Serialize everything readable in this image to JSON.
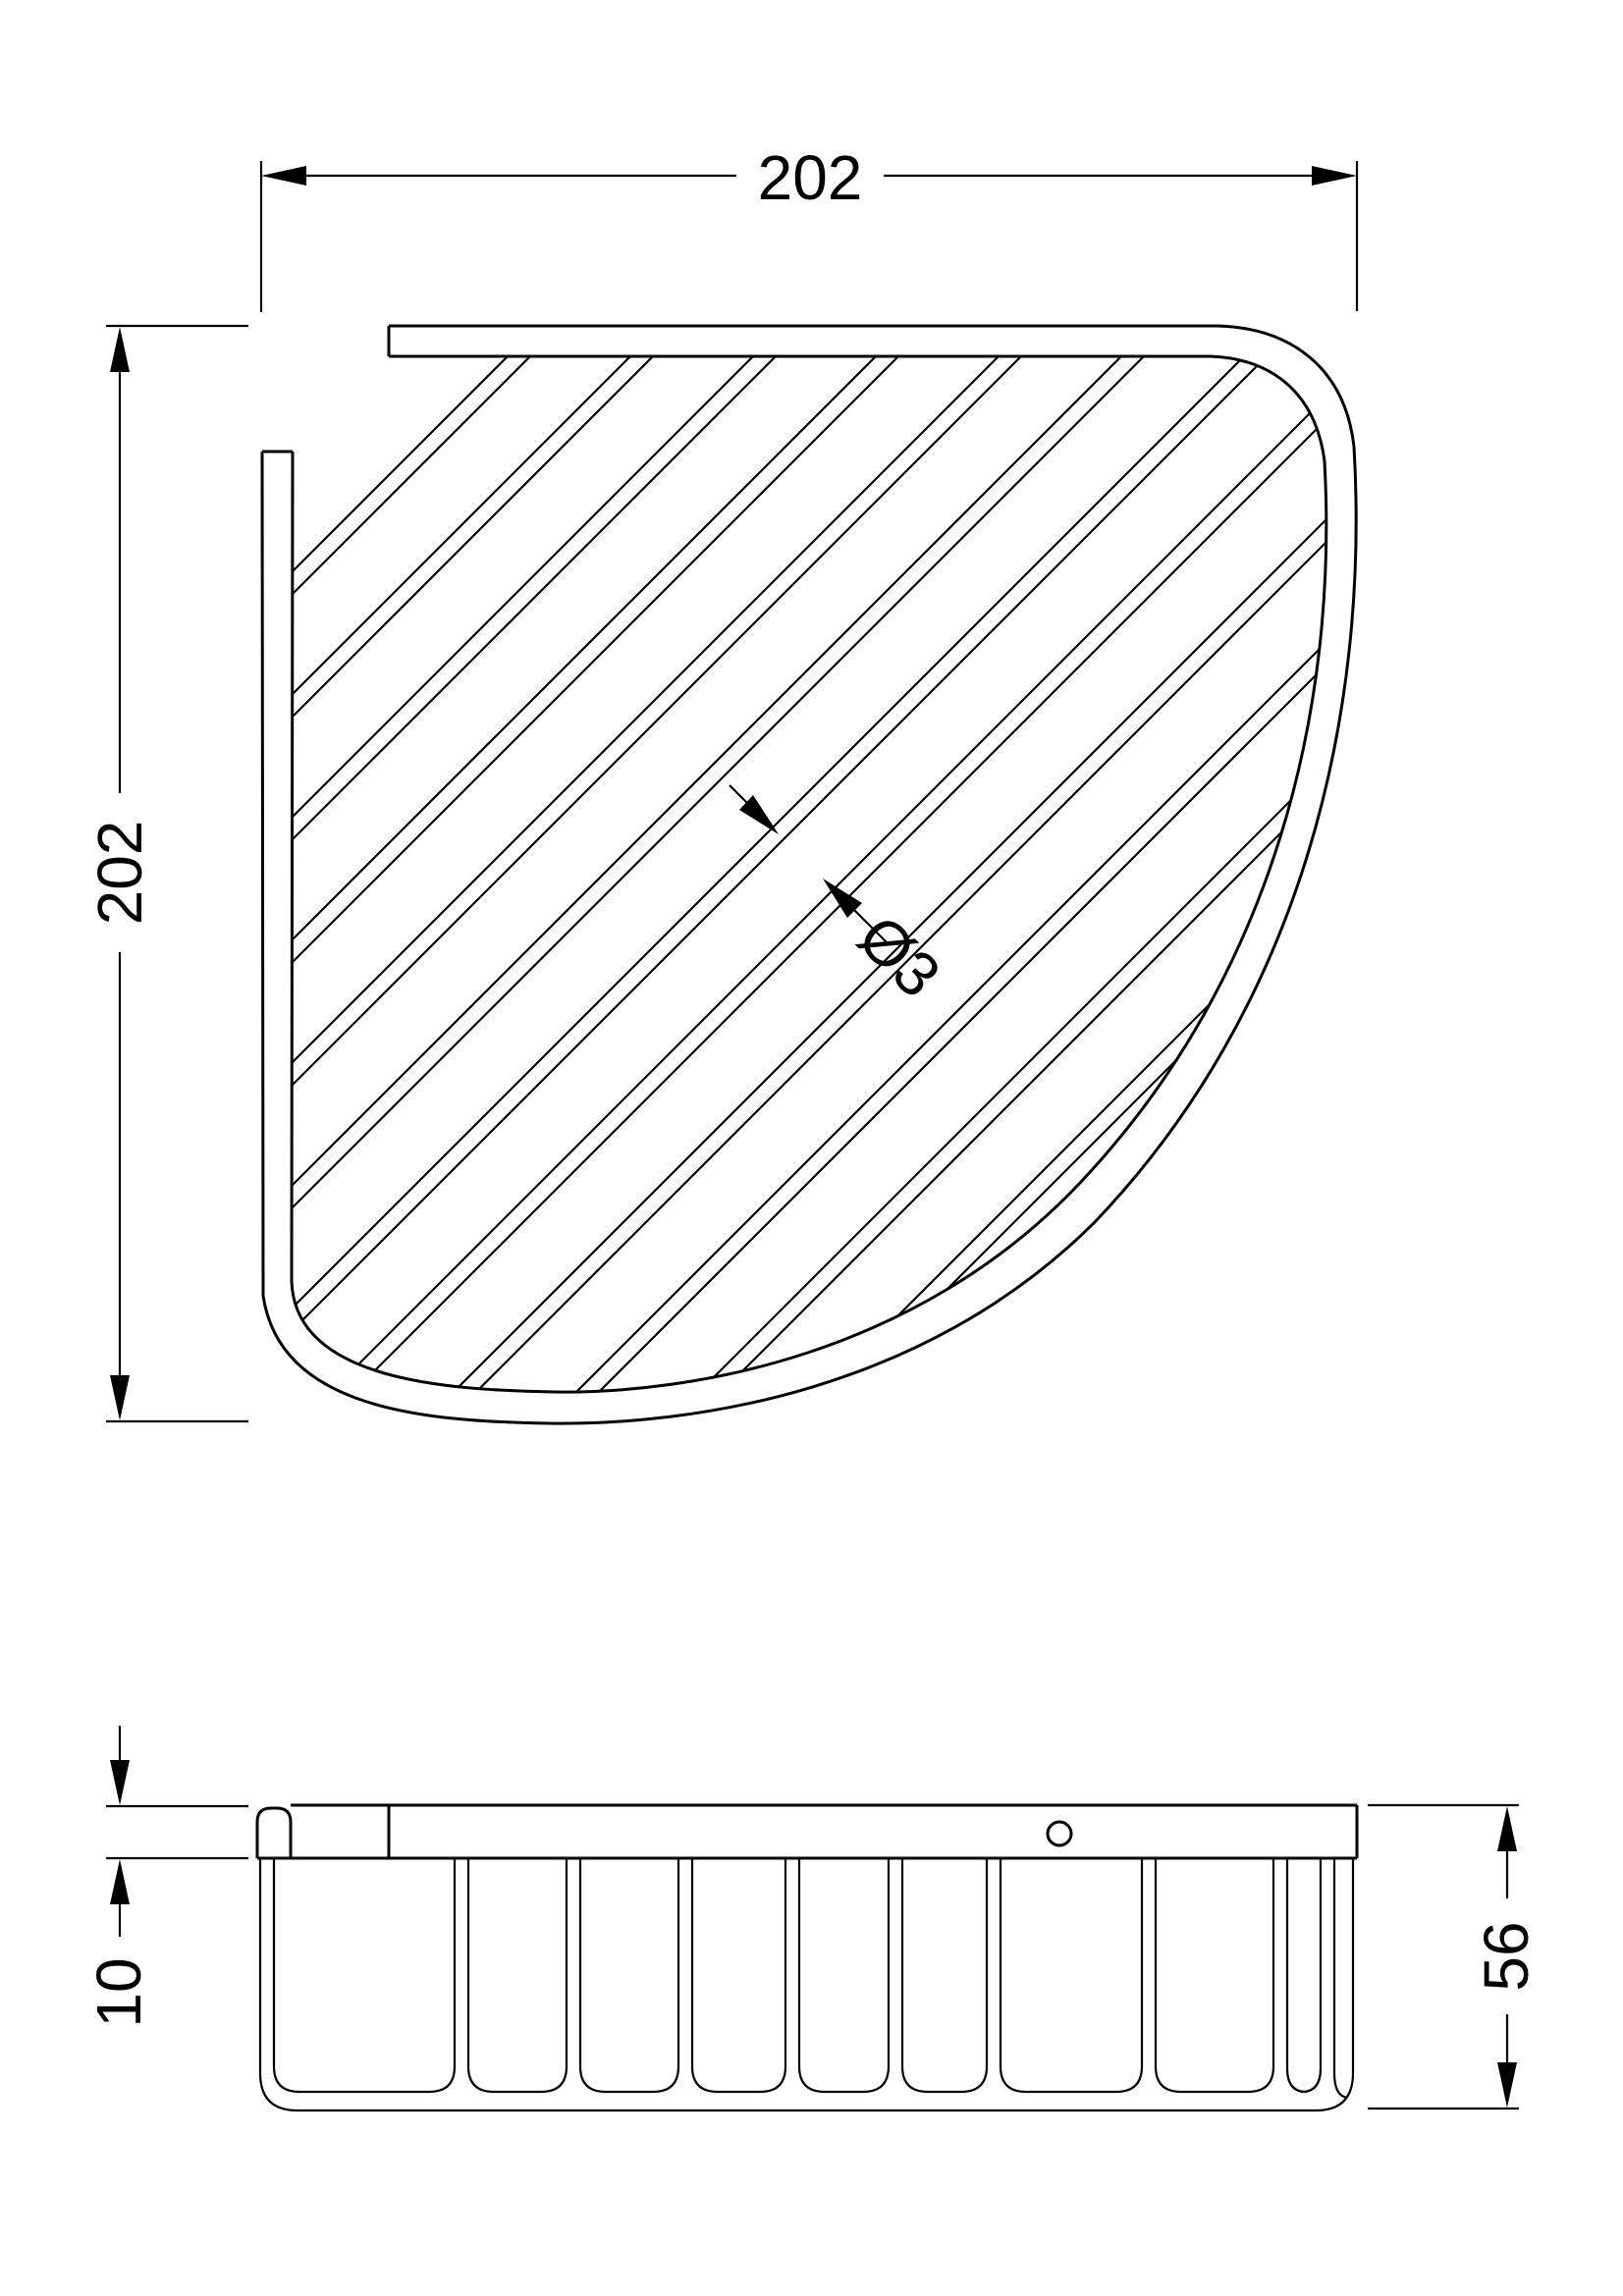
{
  "colors": {
    "background": "#ffffff",
    "line": "#000000"
  },
  "dims": {
    "top_width": "202",
    "top_height": "202",
    "wire_diameter": "Ø3",
    "rail_thickness": "10",
    "basket_depth": "56"
  }
}
